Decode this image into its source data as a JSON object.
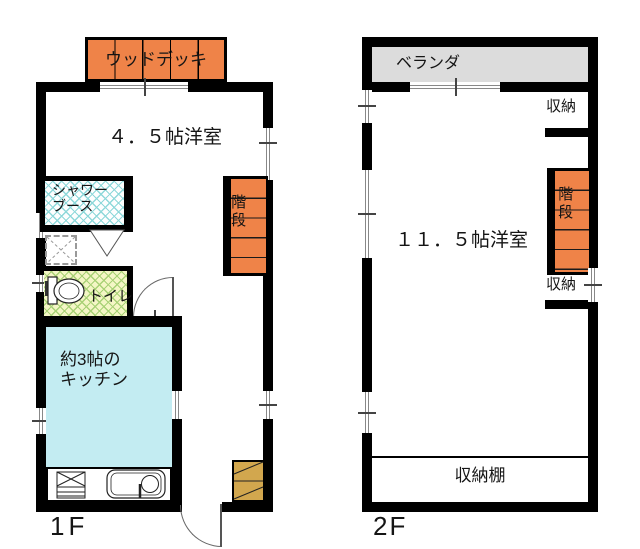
{
  "floor1": {
    "floor_label": "1F",
    "wood_deck_label": "ウッドデッキ",
    "living_room_label": "４．５帖洋室",
    "shower_label_line1": "シャワー",
    "shower_label_line2": "ブース",
    "toilet_label": "トイレ",
    "kitchen_label_line1": "約3帖の",
    "kitchen_label_line2": "キッチン",
    "stairs_label": "階段"
  },
  "floor2": {
    "floor_label": "2F",
    "veranda_label": "ベランダ",
    "storage_top_label": "収納",
    "stairs_label": "階段",
    "storage_bottom_label": "収納",
    "room_label": "１１．５帖洋室",
    "storage_shelf_label": "収納棚"
  },
  "colors": {
    "wall": "#000000",
    "line": "#888888",
    "orange": "#EF8348",
    "veranda": "#DCDCDC",
    "kitchen": "#C3ECF2",
    "toiletbg": "#F4F6C5",
    "toiletline": "#A8D175",
    "showerline": "#8ED8DA",
    "cabinet": "#D2A74E"
  }
}
